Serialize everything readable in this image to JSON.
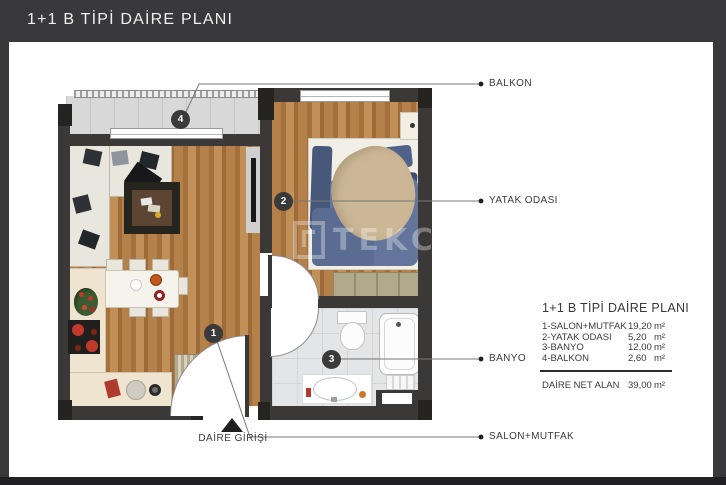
{
  "header": {
    "title": "1+1 B TİPİ DAİRE PLANI"
  },
  "watermark": {
    "text": "TEKCE"
  },
  "plan": {
    "badges": [
      {
        "number": "1"
      },
      {
        "number": "2"
      },
      {
        "number": "3"
      },
      {
        "number": "4"
      }
    ],
    "entrance_label": "DAİRE GİRİŞİ"
  },
  "callouts": {
    "balkon": "BALKON",
    "yatak_odasi": "YATAK ODASI",
    "banyo": "BANYO",
    "salon_mutfak": "SALON+MUTFAK"
  },
  "legend": {
    "title": "1+1 B TİPİ DAİRE PLANI",
    "rows": [
      {
        "name": "1-SALON+MUTFAK",
        "value": "19,20",
        "unit": "m²"
      },
      {
        "name": "2-YATAK ODASI",
        "value": "5,20",
        "unit": "m²"
      },
      {
        "name": "3-BANYO",
        "value": "12,00",
        "unit": "m²"
      },
      {
        "name": "4-BALKON",
        "value": "2,60",
        "unit": "m²"
      }
    ],
    "total": {
      "name": "DAİRE NET ALAN",
      "value": "39,00",
      "unit": "m²"
    }
  },
  "colors": {
    "header_bg": "#39383a",
    "wall": "#3b3937",
    "wood": "#b5814b",
    "accent_red": "#c0392b"
  }
}
